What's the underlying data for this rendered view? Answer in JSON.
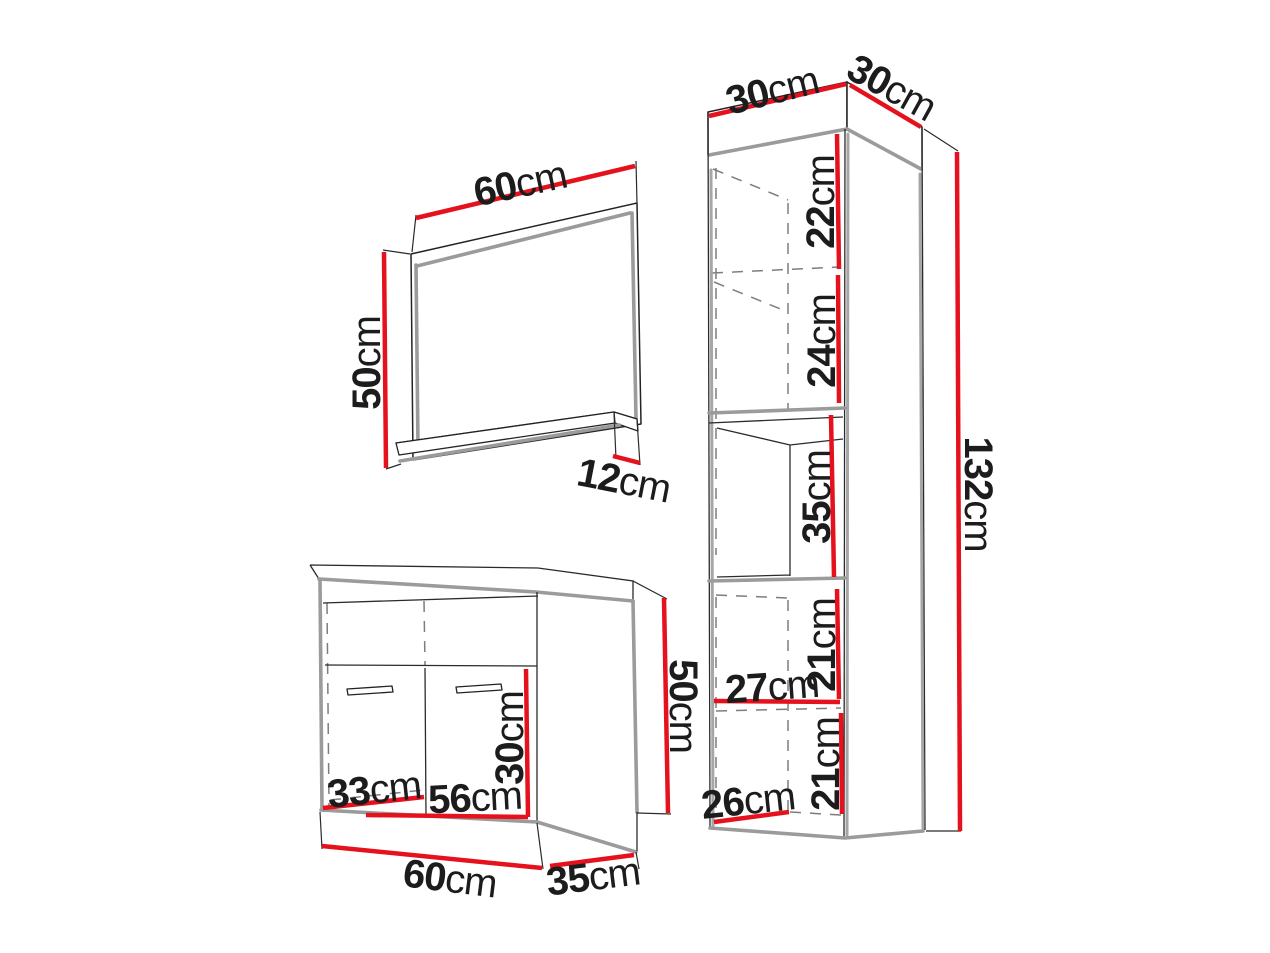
{
  "diagram": {
    "type": "furniture-dimension-diagram",
    "unit": "cm",
    "colors": {
      "dimension_line": "#e5121d",
      "outline": "#232323",
      "shading": "#9b9b9b",
      "hidden_line": "#7d7d7d",
      "background": "#ffffff",
      "label_text": "#1c1c1c"
    },
    "mirror": {
      "width": {
        "value": "60",
        "unit": "cm"
      },
      "height": {
        "value": "50",
        "unit": "cm"
      },
      "shelf_depth": {
        "value": "12",
        "unit": "cm"
      }
    },
    "washbasin_cabinet": {
      "door_height": {
        "value": "30",
        "unit": "cm"
      },
      "inner_depth": {
        "value": "33",
        "unit": "cm"
      },
      "inner_width": {
        "value": "56",
        "unit": "cm"
      },
      "width": {
        "value": "60",
        "unit": "cm"
      },
      "depth": {
        "value": "35",
        "unit": "cm"
      },
      "height": {
        "value": "50",
        "unit": "cm"
      }
    },
    "tall_cabinet": {
      "width": {
        "value": "30",
        "unit": "cm"
      },
      "depth": {
        "value": "30",
        "unit": "cm"
      },
      "height": {
        "value": "132",
        "unit": "cm"
      },
      "section_1": {
        "value": "22",
        "unit": "cm"
      },
      "section_2": {
        "value": "24",
        "unit": "cm"
      },
      "section_3": {
        "value": "35",
        "unit": "cm"
      },
      "section_4": {
        "value": "21",
        "unit": "cm"
      },
      "inner_width": {
        "value": "27",
        "unit": "cm"
      },
      "section_5": {
        "value": "21",
        "unit": "cm"
      },
      "inner_depth": {
        "value": "26",
        "unit": "cm"
      }
    }
  }
}
